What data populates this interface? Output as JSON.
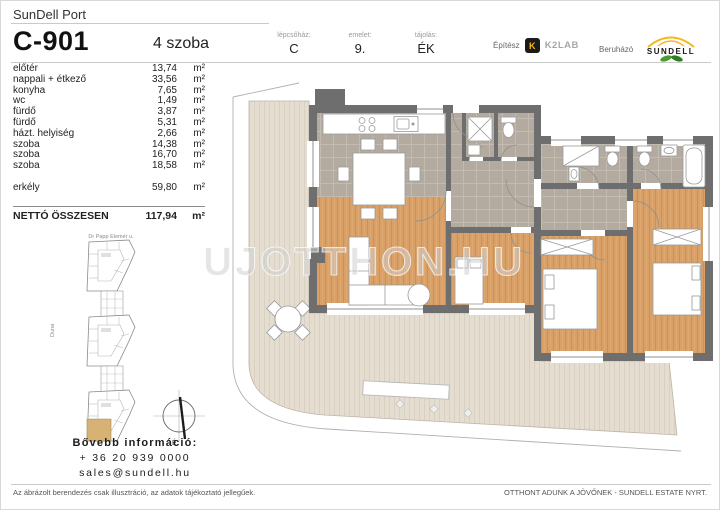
{
  "header": {
    "brand": "SunDell Port",
    "unit_id": "C-901",
    "rooms": "4 szoba",
    "meta": [
      {
        "label": "lépcsőház:",
        "value": "C"
      },
      {
        "label": "emelet:",
        "value": "9."
      },
      {
        "label": "tájolás:",
        "value": "ÉK"
      }
    ],
    "architect_label": "Építész",
    "architect_logo_letter": "K",
    "architect_name": "K2LAB",
    "developer_label": "Beruházó",
    "developer_name": "SUNDELL"
  },
  "area_table": {
    "rows": [
      {
        "name": "előtér",
        "value": "13,74",
        "unit": "m²"
      },
      {
        "name": "nappali + étkező",
        "value": "33,56",
        "unit": "m²"
      },
      {
        "name": "konyha",
        "value": "7,65",
        "unit": "m²"
      },
      {
        "name": "wc",
        "value": "1,49",
        "unit": "m²"
      },
      {
        "name": "fürdő",
        "value": "3,87",
        "unit": "m²"
      },
      {
        "name": "fürdő",
        "value": "5,31",
        "unit": "m²"
      },
      {
        "name": "házt. helyiség",
        "value": "2,66",
        "unit": "m²"
      },
      {
        "name": "szoba",
        "value": "14,38",
        "unit": "m²"
      },
      {
        "name": "szoba",
        "value": "16,70",
        "unit": "m²"
      },
      {
        "name": "szoba",
        "value": "18,58",
        "unit": "m²"
      }
    ],
    "balcony": {
      "name": "erkély",
      "value": "59,80",
      "unit": "m²"
    },
    "total": {
      "name": "NETTÓ ÖSSZESEN",
      "value": "117,94",
      "unit": "m²"
    }
  },
  "site_map": {
    "street_label": "Dr Papp Elemér u.",
    "river_label": "Duna",
    "compass_label": "É",
    "highlight_color": "#d8b274"
  },
  "contact": {
    "heading": "Bővebb információ:",
    "phone": "+ 36 20 939 0000",
    "email": "sales@sundell.hu"
  },
  "watermark": "UJOTTHON.HU",
  "footer": {
    "left": "Az ábrázolt berendezés csak illusztráció, az adatok tájékoztató jellegűek.",
    "right": "OTTHONT ADUNK A JÖVŐNEK - SUNDELL ESTATE NYRT."
  },
  "floor_plan_colors": {
    "wall": "#6e6e6e",
    "wood": "#d9a167",
    "tile": "#b4aba0",
    "deck": "#e4ddd0"
  }
}
